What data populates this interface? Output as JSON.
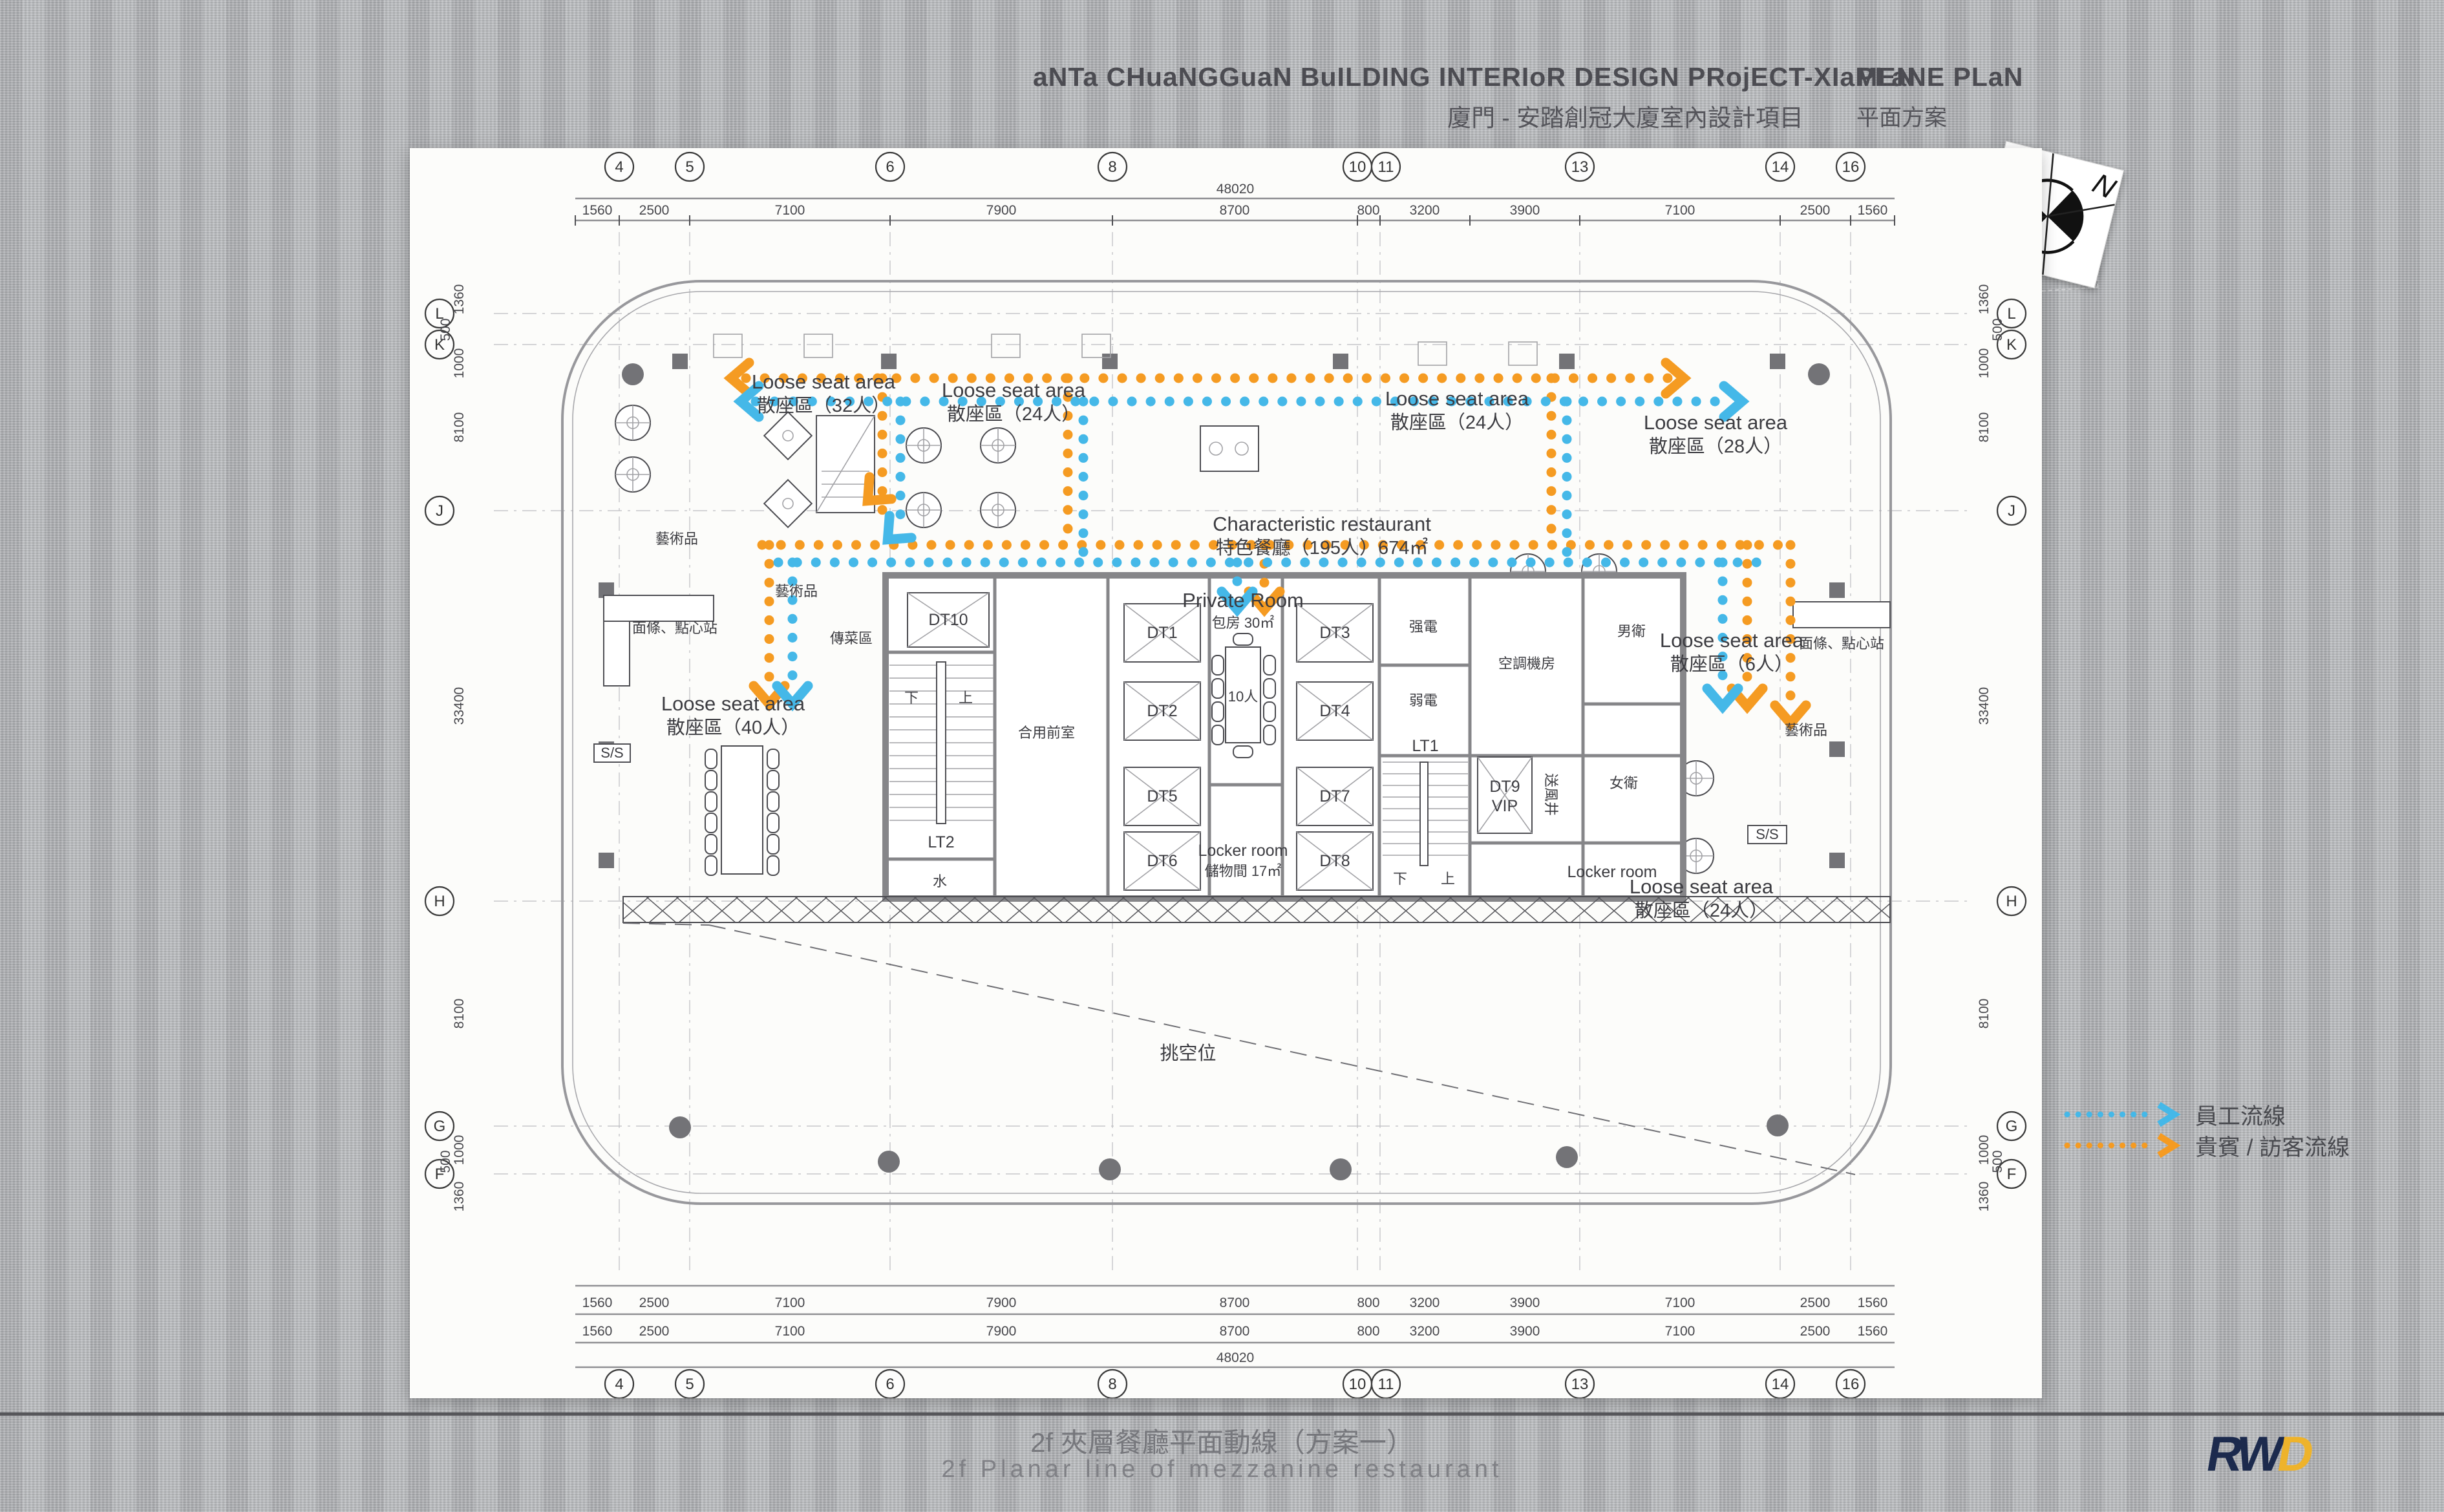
{
  "header": {
    "title_en": "aNTa CHuaNGGuaN BuILDING INTERIoR DESIGN PRojECT-XIaMEN",
    "title_cn": "廈門 - 安踏創冠大廈室內設計項目",
    "plan_en": "PLaNE PLaN",
    "plan_cn": "平面方案"
  },
  "footer": {
    "caption_cn": "2f 夾層餐廳平面動線（方案一）",
    "caption_en": "2f Planar line of mezzanine restaurant",
    "logo_r": "R",
    "logo_w": "W",
    "logo_d": "D"
  },
  "legend": {
    "staff_label": "員工流線",
    "guest_label": "貴賓 / 訪客流線",
    "staff_color": "#45b8e8",
    "guest_color": "#f59b22"
  },
  "compass": {
    "north": "N"
  },
  "grid": {
    "top_numbers": [
      "4",
      "5",
      "6",
      "8",
      "10",
      "11",
      "13",
      "14",
      "16"
    ],
    "side_letters": [
      "L",
      "K",
      "J",
      "H",
      "G",
      "F"
    ],
    "top_dims": [
      "1560",
      "2500",
      "7100",
      "7900",
      "8700",
      "800",
      "3200",
      "3900",
      "7100",
      "2500",
      "1560"
    ],
    "total": "48020",
    "left_dims": [
      "1360",
      "500",
      "1000",
      "8100",
      "33400",
      "8100",
      "1000",
      "500",
      "1360"
    ]
  },
  "areas": {
    "loose32_en": "Loose seat area",
    "loose32_cn": "散座區（32人）",
    "loose24a_en": "Loose seat area",
    "loose24a_cn": "散座區（24人）",
    "loose24b_en": "Loose seat area",
    "loose24b_cn": "散座區（24人）",
    "loose28_en": "Loose seat area",
    "loose28_cn": "散座區（28人）",
    "loose40_en": "Loose seat area",
    "loose40_cn": "散座區（40人）",
    "loose6_en": "Loose seat area",
    "loose6_cn": "散座區（6人）",
    "loose24c_en": "Loose seat area",
    "loose24c_cn": "散座區（24人）",
    "restaurant_en": "Characteristic restaurant",
    "restaurant_cn": "特色餐廳（195人）674㎡",
    "void_cn": "挑空位"
  },
  "rooms": {
    "private_en": "Private Room",
    "private_cn": "包房 30㎡",
    "private_seats": "10人",
    "locker1_en": "Locker room",
    "locker1_cn": "儲物間 17㎡",
    "locker2_en": "Locker room",
    "dt10": "DT10",
    "dt1": "DT1",
    "dt2": "DT2",
    "dt3": "DT3",
    "dt4": "DT4",
    "dt5": "DT5",
    "dt6": "DT6",
    "dt7": "DT7",
    "dt8": "DT8",
    "dt9": "DT9",
    "vip": "VIP",
    "lt1": "LT1",
    "lt2": "LT2",
    "strong_elec": "强電",
    "weak_elec": "弱電",
    "hvac": "空調機房",
    "mens": "男衛",
    "womens": "女衛",
    "supply_shaft": "送風井",
    "water": "水",
    "lobby": "合用前室",
    "down": "下",
    "up": "上",
    "pass_area": "傳菜區",
    "noodle_station": "面條、點心站",
    "art": "藝術品",
    "ss": "S/S"
  }
}
